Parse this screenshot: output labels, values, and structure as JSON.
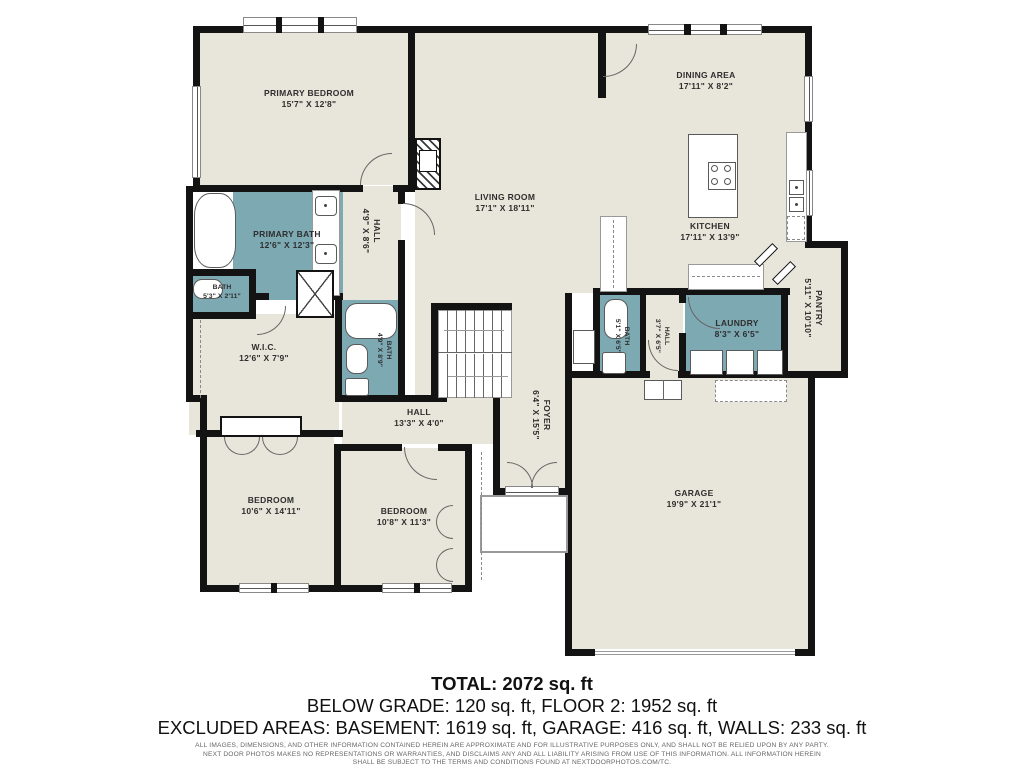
{
  "colors": {
    "room_fill": "#e8e5da",
    "wet_fill": "#7da9b3",
    "wall": "#131313"
  },
  "rooms": {
    "primary_bedroom": {
      "name": "PRIMARY BEDROOM",
      "dims": "15'7\" X 12'8\""
    },
    "living_room": {
      "name": "LIVING ROOM",
      "dims": "17'1\" X 18'11\""
    },
    "dining_area": {
      "name": "DINING AREA",
      "dims": "17'11\" X 8'2\""
    },
    "kitchen": {
      "name": "KITCHEN",
      "dims": "17'11\" X 13'9\""
    },
    "pantry": {
      "name": "PANTRY",
      "dims": "5'11\" X 10'10\""
    },
    "laundry": {
      "name": "LAUNDRY",
      "dims": "8'3\" X 6'5\""
    },
    "bath_mud": {
      "name": "BATH",
      "dims": "5'1\" X 6'5\""
    },
    "hall_mud": {
      "name": "HALL",
      "dims": "3'7\" X 6'5\""
    },
    "primary_bath": {
      "name": "PRIMARY BATH",
      "dims": "12'6\" X 12'3\""
    },
    "bath_small": {
      "name": "BATH",
      "dims": "5'3\" X 2'11\""
    },
    "hall_upper": {
      "name": "HALL",
      "dims": "4'9\" X 8'6\""
    },
    "wic": {
      "name": "W.I.C.",
      "dims": "12'6\" X 7'9\""
    },
    "bath_mid": {
      "name": "BATH",
      "dims": "4'9\" X 8'9\""
    },
    "hall_south": {
      "name": "HALL",
      "dims": "13'3\" X 4'0\""
    },
    "foyer": {
      "name": "FOYER",
      "dims": "6'4\" X 15'5\""
    },
    "bedroom_left": {
      "name": "BEDROOM",
      "dims": "10'6\" X 14'11\""
    },
    "bedroom_mid": {
      "name": "BEDROOM",
      "dims": "10'8\" X 11'3\""
    },
    "garage": {
      "name": "GARAGE",
      "dims": "19'9\" X 21'1\""
    }
  },
  "footer": {
    "total": "TOTAL: 2072 sq. ft",
    "grade_line": "BELOW GRADE: 120 sq. ft, FLOOR 2: 1952 sq. ft",
    "excluded_line": "EXCLUDED AREAS: BASEMENT: 1619 sq. ft, GARAGE: 416 sq. ft, WALLS: 233 sq. ft",
    "disclaimer_line1": "ALL IMAGES, DIMENSIONS, AND OTHER INFORMATION CONTAINED HEREIN ARE APPROXIMATE AND FOR ILLUSTRATIVE PURPOSES ONLY, AND SHALL NOT BE RELIED UPON BY ANY PARTY.",
    "disclaimer_line2": "NEXT DOOR PHOTOS MAKES NO REPRESENTATIONS OR WARRANTIES, AND DISCLAIMS ANY AND ALL LIABILITY ARISING FROM USE OF THIS INFORMATION. ALL INFORMATION HEREIN",
    "disclaimer_line3": "SHALL BE SUBJECT TO THE TERMS AND CONDITIONS FOUND AT NEXTDOORPHOTOS.COM/TC."
  }
}
